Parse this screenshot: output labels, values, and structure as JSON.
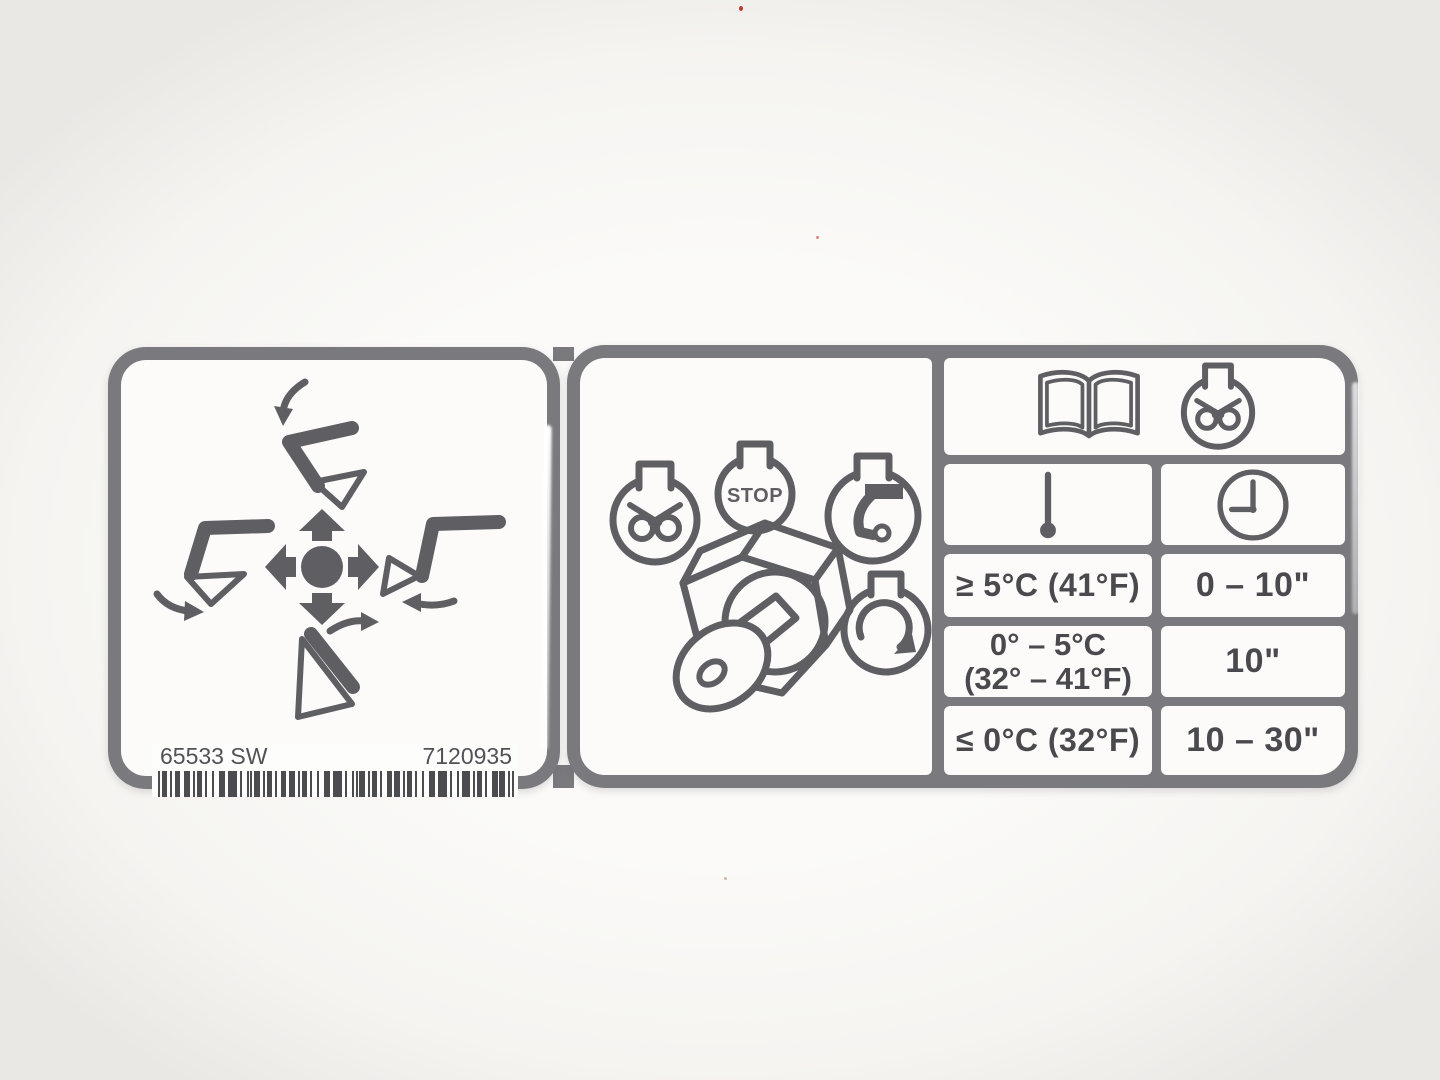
{
  "photo": {
    "background": "#f7f5f2"
  },
  "colors": {
    "sticker_border": "#7a7a7e",
    "ink": "#5f5f63",
    "text": "#4a4a4e",
    "label_bg": "#fcfbfa"
  },
  "left_sticker": {
    "part_number_left": "65533 SW",
    "part_number_right": "7120935",
    "icons": [
      "bucket-lower-icon",
      "bucket-curl-left-icon",
      "joystick-4way-icon",
      "bucket-curl-right-icon",
      "bucket-dump-icon",
      "barcode"
    ]
  },
  "key_switch_panel": {
    "icons": [
      "glow-plug-position-icon",
      "stop-position-icon",
      "run-position-icon",
      "start-position-icon",
      "ignition-key-switch-icon"
    ],
    "stop_label": "STOP"
  },
  "preheat_table": {
    "header_icons": [
      "operator-manual-icon",
      "glow-plug-icon"
    ],
    "column_icons": [
      "thermometer-icon",
      "clock-icon"
    ],
    "rows": [
      {
        "temperature": "≥ 5°C (41°F)",
        "time": "0 – 10\""
      },
      {
        "temperature_line1": "0° – 5°C",
        "temperature_line2": "(32° – 41°F)",
        "time": "10\""
      },
      {
        "temperature": "≤ 0°C (32°F)",
        "time": "10 – 30\""
      }
    ]
  }
}
